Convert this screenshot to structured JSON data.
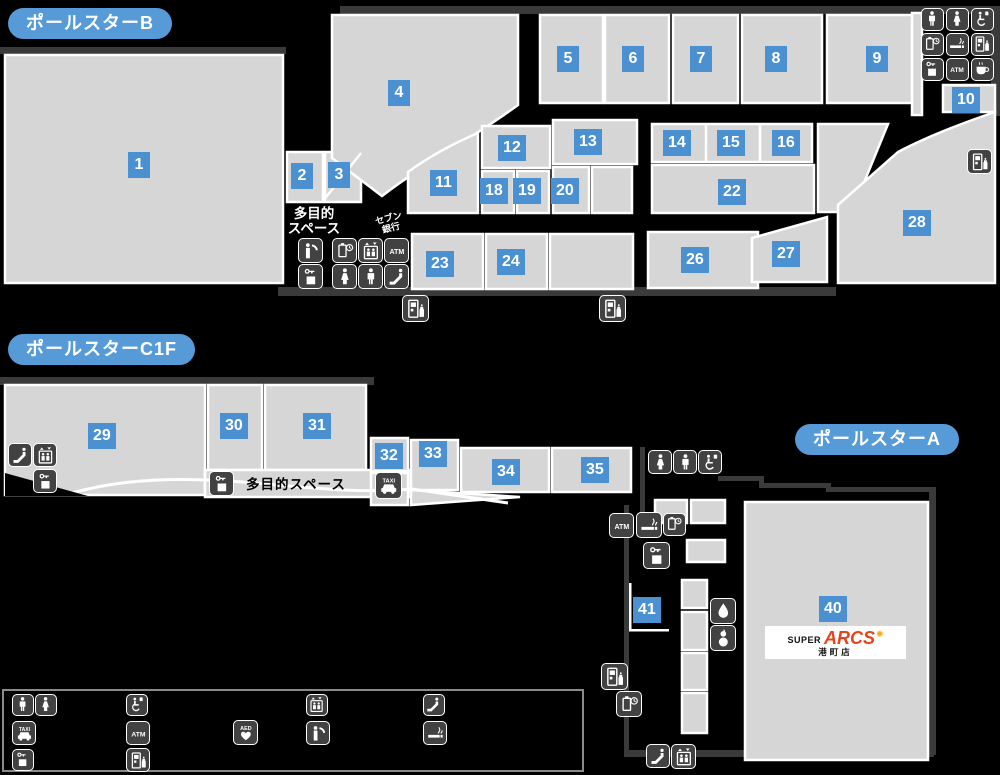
{
  "sections": {
    "b": {
      "label": "ポールスターB"
    },
    "c1f": {
      "label": "ポールスターC1F"
    },
    "a": {
      "label": "ポールスターA"
    }
  },
  "labels": {
    "multipurpose_b": [
      "多目的",
      "スペース"
    ],
    "multipurpose_c1f": "多目的スペース",
    "seven_bank": [
      "セブン",
      "銀行"
    ]
  },
  "store_sign": {
    "super": "SUPER",
    "name": "ARCS",
    "branch": "港町店"
  },
  "colors": {
    "room_number_bg": "#4b90d0",
    "section_pill_bg": "#569bd8",
    "room_fill": "#d6d6d6",
    "building_outline": "#3a3a3a",
    "icon_bg": "#424242",
    "arcs_red": "#e8441c",
    "arcs_star": "#f7a70a"
  },
  "rooms": [
    {
      "num": "1",
      "x": 128,
      "y": 152
    },
    {
      "num": "2",
      "x": 291,
      "y": 163
    },
    {
      "num": "3",
      "x": 328,
      "y": 162
    },
    {
      "num": "4",
      "x": 388,
      "y": 80
    },
    {
      "num": "5",
      "x": 557,
      "y": 46
    },
    {
      "num": "6",
      "x": 622,
      "y": 46
    },
    {
      "num": "7",
      "x": 690,
      "y": 46
    },
    {
      "num": "8",
      "x": 765,
      "y": 46
    },
    {
      "num": "9",
      "x": 866,
      "y": 46
    },
    {
      "num": "10",
      "x": 952,
      "y": 87
    },
    {
      "num": "11",
      "x": 430,
      "y": 170
    },
    {
      "num": "12",
      "x": 498,
      "y": 135
    },
    {
      "num": "13",
      "x": 574,
      "y": 129
    },
    {
      "num": "14",
      "x": 663,
      "y": 130
    },
    {
      "num": "15",
      "x": 717,
      "y": 130
    },
    {
      "num": "16",
      "x": 772,
      "y": 130
    },
    {
      "num": "18",
      "x": 480,
      "y": 178
    },
    {
      "num": "19",
      "x": 513,
      "y": 178
    },
    {
      "num": "20",
      "x": 551,
      "y": 178
    },
    {
      "num": "22",
      "x": 718,
      "y": 179
    },
    {
      "num": "23",
      "x": 426,
      "y": 251
    },
    {
      "num": "24",
      "x": 497,
      "y": 249
    },
    {
      "num": "26",
      "x": 681,
      "y": 247
    },
    {
      "num": "27",
      "x": 772,
      "y": 241
    },
    {
      "num": "28",
      "x": 903,
      "y": 210
    },
    {
      "num": "29",
      "x": 88,
      "y": 423
    },
    {
      "num": "30",
      "x": 220,
      "y": 413
    },
    {
      "num": "31",
      "x": 303,
      "y": 413
    },
    {
      "num": "32",
      "x": 375,
      "y": 443
    },
    {
      "num": "33",
      "x": 419,
      "y": 441
    },
    {
      "num": "34",
      "x": 492,
      "y": 459
    },
    {
      "num": "35",
      "x": 581,
      "y": 457
    },
    {
      "num": "40",
      "x": 819,
      "y": 596
    },
    {
      "num": "41",
      "x": 633,
      "y": 597
    }
  ],
  "map_icons": [
    {
      "n": "male-toilet",
      "x": 921,
      "y": 8,
      "s": 23
    },
    {
      "n": "female-toilet",
      "x": 946,
      "y": 8,
      "s": 23
    },
    {
      "n": "accessible-toilet",
      "x": 971,
      "y": 8,
      "s": 23
    },
    {
      "n": "phone-charging",
      "x": 921,
      "y": 33,
      "s": 23
    },
    {
      "n": "smoking",
      "x": 946,
      "y": 33,
      "s": 23
    },
    {
      "n": "vending-machine",
      "x": 971,
      "y": 33,
      "s": 23
    },
    {
      "n": "coin-locker",
      "x": 921,
      "y": 58,
      "s": 23
    },
    {
      "n": "atm",
      "x": 946,
      "y": 58,
      "s": 23
    },
    {
      "n": "cafe",
      "x": 971,
      "y": 58,
      "s": 23
    },
    {
      "n": "telephone",
      "x": 298,
      "y": 238,
      "s": 25
    },
    {
      "n": "coin-locker",
      "x": 298,
      "y": 264,
      "s": 25
    },
    {
      "n": "phone-charging",
      "x": 332,
      "y": 238,
      "s": 25
    },
    {
      "n": "elevator",
      "x": 358,
      "y": 238,
      "s": 25
    },
    {
      "n": "atm",
      "x": 384,
      "y": 238,
      "s": 25
    },
    {
      "n": "female-toilet",
      "x": 332,
      "y": 264,
      "s": 25
    },
    {
      "n": "male-toilet",
      "x": 358,
      "y": 264,
      "s": 25
    },
    {
      "n": "escalator",
      "x": 384,
      "y": 264,
      "s": 25
    },
    {
      "n": "vending-machine",
      "x": 402,
      "y": 295,
      "s": 27
    },
    {
      "n": "vending-machine",
      "x": 599,
      "y": 295,
      "s": 27
    },
    {
      "n": "vending-machine",
      "x": 967,
      "y": 149,
      "s": 25
    },
    {
      "n": "escalator",
      "x": 8,
      "y": 443,
      "s": 24
    },
    {
      "n": "elevator",
      "x": 33,
      "y": 443,
      "s": 24
    },
    {
      "n": "coin-locker",
      "x": 33,
      "y": 469,
      "s": 24
    },
    {
      "n": "coin-locker",
      "x": 209,
      "y": 471,
      "s": 25
    },
    {
      "n": "taxi",
      "x": 375,
      "y": 472,
      "s": 27
    },
    {
      "n": "female-toilet",
      "x": 648,
      "y": 450,
      "s": 24
    },
    {
      "n": "male-toilet",
      "x": 673,
      "y": 450,
      "s": 24
    },
    {
      "n": "accessible-toilet",
      "x": 698,
      "y": 450,
      "s": 24
    },
    {
      "n": "atm",
      "x": 609,
      "y": 513,
      "s": 25
    },
    {
      "n": "smoking",
      "x": 636,
      "y": 512,
      "s": 26
    },
    {
      "n": "phone-charging",
      "x": 663,
      "y": 513,
      "s": 23
    },
    {
      "n": "coin-locker",
      "x": 643,
      "y": 542,
      "s": 27
    },
    {
      "n": "water-fountain",
      "x": 710,
      "y": 598,
      "s": 26
    },
    {
      "n": "baby-room",
      "x": 710,
      "y": 625,
      "s": 26
    },
    {
      "n": "vending-machine",
      "x": 601,
      "y": 663,
      "s": 27
    },
    {
      "n": "phone-charging",
      "x": 616,
      "y": 691,
      "s": 26
    },
    {
      "n": "escalator",
      "x": 646,
      "y": 744,
      "s": 24
    },
    {
      "n": "elevator",
      "x": 671,
      "y": 744,
      "s": 25
    }
  ],
  "legend": {
    "items": [
      {
        "n": "male-toilet",
        "x": 12,
        "y": 694,
        "s": 22
      },
      {
        "n": "female-toilet",
        "x": 35,
        "y": 694,
        "s": 22
      },
      {
        "n": "accessible-toilet",
        "x": 126,
        "y": 694,
        "s": 22
      },
      {
        "n": "elevator",
        "x": 306,
        "y": 694,
        "s": 22
      },
      {
        "n": "escalator",
        "x": 423,
        "y": 694,
        "s": 22
      },
      {
        "n": "taxi",
        "x": 12,
        "y": 721,
        "s": 24
      },
      {
        "n": "atm",
        "x": 126,
        "y": 721,
        "s": 24
      },
      {
        "n": "aed",
        "x": 233,
        "y": 720,
        "s": 25
      },
      {
        "n": "telephone",
        "x": 306,
        "y": 721,
        "s": 24
      },
      {
        "n": "smoking",
        "x": 423,
        "y": 721,
        "s": 24
      },
      {
        "n": "coin-locker",
        "x": 12,
        "y": 749,
        "s": 22
      },
      {
        "n": "vending-machine",
        "x": 126,
        "y": 748,
        "s": 24
      }
    ]
  }
}
